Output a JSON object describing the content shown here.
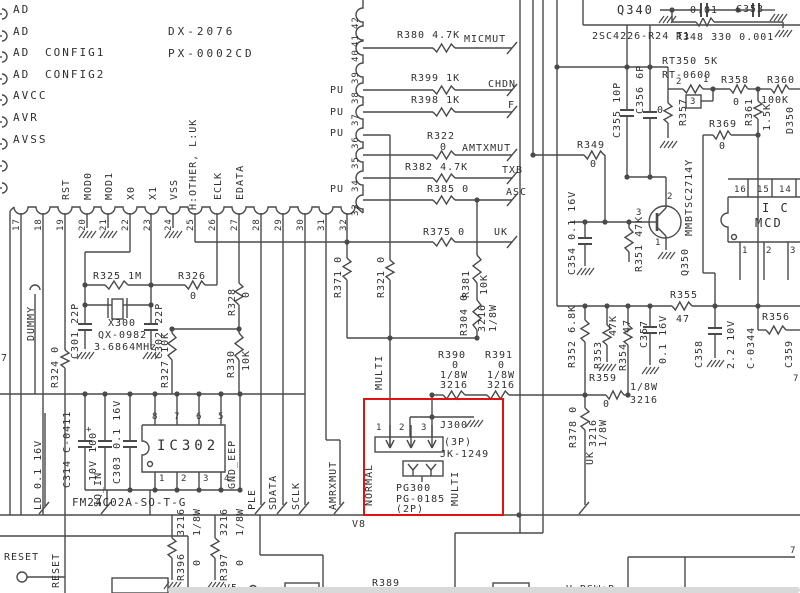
{
  "colors": {
    "background": "#ffffff",
    "wire": "#4a4a4a",
    "text": "#303030",
    "highlight": "#e01212",
    "window_edge": "#d9d9d9"
  },
  "highlight": {
    "x": 363,
    "y": 398,
    "w": 137,
    "h": 114
  },
  "window_edge": {
    "x": 168,
    "y": 587,
    "w": 632,
    "h": 6
  },
  "schematic": {
    "labels": [
      {
        "t": "AD",
        "x": 13,
        "y": 4,
        "s": 11,
        "ls": 2
      },
      {
        "t": "AD",
        "x": 13,
        "y": 26,
        "s": 11,
        "ls": 2
      },
      {
        "t": "AD",
        "x": 13,
        "y": 47,
        "s": 11,
        "ls": 2
      },
      {
        "t": "CONFIG1",
        "x": 45,
        "y": 47,
        "s": 11,
        "ls": 2
      },
      {
        "t": "AD",
        "x": 13,
        "y": 69,
        "s": 11,
        "ls": 2
      },
      {
        "t": "CONFIG2",
        "x": 45,
        "y": 69,
        "s": 11,
        "ls": 2
      },
      {
        "t": "AVCC",
        "x": 13,
        "y": 90,
        "s": 11,
        "ls": 2
      },
      {
        "t": "AVR",
        "x": 13,
        "y": 112,
        "s": 11,
        "ls": 2
      },
      {
        "t": "AVSS",
        "x": 13,
        "y": 134,
        "s": 11,
        "ls": 2
      },
      {
        "t": "DX-2076",
        "x": 168,
        "y": 26,
        "s": 11,
        "ls": 3
      },
      {
        "t": "PX-0002CD",
        "x": 168,
        "y": 48,
        "s": 11,
        "ls": 3
      },
      {
        "t": "H:OTHER, L:UK",
        "x": 188,
        "y": 210,
        "o": "v"
      },
      {
        "t": "RST",
        "x": 61,
        "y": 200,
        "o": "v"
      },
      {
        "t": "MOD0",
        "x": 83,
        "y": 200,
        "o": "v"
      },
      {
        "t": "MOD1",
        "x": 104,
        "y": 200,
        "o": "v"
      },
      {
        "t": "X0",
        "x": 126,
        "y": 200,
        "o": "v"
      },
      {
        "t": "X1",
        "x": 148,
        "y": 200,
        "o": "v"
      },
      {
        "t": "VSS",
        "x": 169,
        "y": 200,
        "o": "v"
      },
      {
        "t": "ECLK",
        "x": 213,
        "y": 200,
        "o": "v"
      },
      {
        "t": "EDATA",
        "x": 235,
        "y": 200,
        "o": "v"
      },
      {
        "t": "17",
        "x": 12,
        "y": 231,
        "o": "v",
        "s": 9
      },
      {
        "t": "18",
        "x": 34,
        "y": 231,
        "o": "v",
        "s": 9
      },
      {
        "t": "19",
        "x": 56,
        "y": 231,
        "o": "v",
        "s": 9
      },
      {
        "t": "20",
        "x": 78,
        "y": 231,
        "o": "v",
        "s": 9
      },
      {
        "t": "21",
        "x": 99,
        "y": 231,
        "o": "v",
        "s": 9
      },
      {
        "t": "22",
        "x": 121,
        "y": 231,
        "o": "v",
        "s": 9
      },
      {
        "t": "23",
        "x": 143,
        "y": 231,
        "o": "v",
        "s": 9
      },
      {
        "t": "24",
        "x": 164,
        "y": 231,
        "o": "v",
        "s": 9
      },
      {
        "t": "25",
        "x": 186,
        "y": 231,
        "o": "v",
        "s": 9
      },
      {
        "t": "26",
        "x": 208,
        "y": 231,
        "o": "v",
        "s": 9
      },
      {
        "t": "27",
        "x": 230,
        "y": 231,
        "o": "v",
        "s": 9
      },
      {
        "t": "28",
        "x": 252,
        "y": 231,
        "o": "v",
        "s": 9
      },
      {
        "t": "29",
        "x": 274,
        "y": 231,
        "o": "v",
        "s": 9
      },
      {
        "t": "30",
        "x": 296,
        "y": 231,
        "o": "v",
        "s": 9
      },
      {
        "t": "31",
        "x": 317,
        "y": 231,
        "o": "v",
        "s": 9
      },
      {
        "t": "32",
        "x": 339,
        "y": 231,
        "o": "v",
        "s": 9
      },
      {
        "t": "33",
        "x": 351,
        "y": 216,
        "o": "v",
        "s": 9
      },
      {
        "t": "34",
        "x": 351,
        "y": 192,
        "o": "v",
        "s": 9
      },
      {
        "t": "35",
        "x": 351,
        "y": 169,
        "o": "v",
        "s": 9
      },
      {
        "t": "36",
        "x": 351,
        "y": 149,
        "o": "v",
        "s": 9
      },
      {
        "t": "37",
        "x": 351,
        "y": 126,
        "o": "v",
        "s": 9
      },
      {
        "t": "38",
        "x": 351,
        "y": 104,
        "o": "v",
        "s": 9
      },
      {
        "t": "39",
        "x": 351,
        "y": 84,
        "o": "v",
        "s": 9
      },
      {
        "t": "40",
        "x": 351,
        "y": 62,
        "o": "v",
        "s": 9
      },
      {
        "t": "41",
        "x": 351,
        "y": 47,
        "o": "v",
        "s": 9
      },
      {
        "t": "42",
        "x": 351,
        "y": 29,
        "o": "v",
        "s": 9
      },
      {
        "t": "PU",
        "x": 330,
        "y": 85
      },
      {
        "t": "PU",
        "x": 330,
        "y": 107
      },
      {
        "t": "PU",
        "x": 330,
        "y": 128
      },
      {
        "t": "PU",
        "x": 330,
        "y": 184
      },
      {
        "t": "R380 4.7K",
        "x": 397,
        "y": 30
      },
      {
        "t": "MICMUT",
        "x": 464,
        "y": 34
      },
      {
        "t": "R399 1K",
        "x": 411,
        "y": 73
      },
      {
        "t": "CHDN",
        "x": 488,
        "y": 79
      },
      {
        "t": "R398 1K",
        "x": 411,
        "y": 95
      },
      {
        "t": "F",
        "x": 508,
        "y": 100
      },
      {
        "t": "R322",
        "x": 427,
        "y": 131
      },
      {
        "t": "0",
        "x": 440,
        "y": 142
      },
      {
        "t": "AMTXMUT",
        "x": 462,
        "y": 143
      },
      {
        "t": "R382 4.7K",
        "x": 405,
        "y": 162
      },
      {
        "t": "TXB",
        "x": 502,
        "y": 165
      },
      {
        "t": "R385 0",
        "x": 427,
        "y": 184
      },
      {
        "t": "ASC",
        "x": 506,
        "y": 187
      },
      {
        "t": "R375 0",
        "x": 423,
        "y": 227
      },
      {
        "t": "UK",
        "x": 494,
        "y": 227
      },
      {
        "t": "DUMMY",
        "x": 26,
        "y": 341,
        "o": "v"
      },
      {
        "t": "7",
        "x": 1,
        "y": 353
      },
      {
        "t": "R324 0",
        "x": 50,
        "y": 388,
        "o": "v"
      },
      {
        "t": "R325 1M",
        "x": 93,
        "y": 271
      },
      {
        "t": "R326",
        "x": 178,
        "y": 271
      },
      {
        "t": "0",
        "x": 190,
        "y": 291
      },
      {
        "t": "C301 22P",
        "x": 70,
        "y": 359,
        "o": "v"
      },
      {
        "t": "C302 22P",
        "x": 154,
        "y": 359,
        "o": "v"
      },
      {
        "t": "X300",
        "x": 108,
        "y": 318
      },
      {
        "t": "QX-0982",
        "x": 98,
        "y": 330
      },
      {
        "t": "3.6864MHz",
        "x": 94,
        "y": 342
      },
      {
        "t": "R327 10K",
        "x": 160,
        "y": 388,
        "o": "v"
      },
      {
        "t": "R328",
        "x": 227,
        "y": 316,
        "o": "v"
      },
      {
        "t": "0",
        "x": 241,
        "y": 298,
        "o": "v"
      },
      {
        "t": "R330",
        "x": 226,
        "y": 378,
        "o": "v"
      },
      {
        "t": "10K",
        "x": 241,
        "y": 371,
        "o": "v"
      },
      {
        "t": "R371 0",
        "x": 333,
        "y": 298,
        "o": "v"
      },
      {
        "t": "R321 0",
        "x": 376,
        "y": 298,
        "o": "v"
      },
      {
        "t": "R381",
        "x": 461,
        "y": 298,
        "o": "v"
      },
      {
        "t": "10K",
        "x": 479,
        "y": 295,
        "o": "v"
      },
      {
        "t": "R304 0",
        "x": 459,
        "y": 336,
        "o": "v"
      },
      {
        "t": "3216",
        "x": 477,
        "y": 332,
        "o": "v"
      },
      {
        "t": "1/8W",
        "x": 488,
        "y": 332,
        "o": "v"
      },
      {
        "t": "MULTI",
        "x": 374,
        "y": 390,
        "o": "v"
      },
      {
        "t": "C314 C-0411",
        "x": 62,
        "y": 488,
        "o": "v"
      },
      {
        "t": "+",
        "x": 86,
        "y": 425,
        "s": 9
      },
      {
        "t": "10V 100",
        "x": 88,
        "y": 481,
        "o": "v"
      },
      {
        "t": "C303 0.1 16V",
        "x": 112,
        "y": 484,
        "o": "v"
      },
      {
        "t": "8",
        "x": 152,
        "y": 412,
        "s": 9
      },
      {
        "t": "7",
        "x": 174,
        "y": 412,
        "s": 9
      },
      {
        "t": "6",
        "x": 196,
        "y": 412,
        "s": 9
      },
      {
        "t": "5",
        "x": 218,
        "y": 412,
        "s": 9
      },
      {
        "t": "1",
        "x": 159,
        "y": 474,
        "s": 9
      },
      {
        "t": "2",
        "x": 181,
        "y": 474,
        "s": 9
      },
      {
        "t": "3",
        "x": 203,
        "y": 474,
        "s": 9
      },
      {
        "t": "4",
        "x": 224,
        "y": 474,
        "s": 9
      },
      {
        "t": "IC302",
        "x": 157,
        "y": 441,
        "s": 14,
        "ls": 4
      },
      {
        "t": "FM24C02A-SO-T-G",
        "x": 72,
        "y": 497,
        "s": 11
      },
      {
        "t": "GND_EEP",
        "x": 227,
        "y": 489,
        "o": "v"
      },
      {
        "t": "PLE",
        "x": 247,
        "y": 510,
        "o": "v"
      },
      {
        "t": "SDATA",
        "x": 268,
        "y": 510,
        "o": "v"
      },
      {
        "t": "SCLK",
        "x": 291,
        "y": 510,
        "o": "v"
      },
      {
        "t": "AMRXMUT",
        "x": 328,
        "y": 510,
        "o": "v"
      },
      {
        "t": "LD 0.1 16V",
        "x": 33,
        "y": 510,
        "o": "v"
      },
      {
        "t": "SQ_IN",
        "x": 93,
        "y": 507,
        "o": "v"
      },
      {
        "t": "R390",
        "x": 438,
        "y": 350
      },
      {
        "t": "0",
        "x": 452,
        "y": 360
      },
      {
        "t": "1/8W",
        "x": 440,
        "y": 370
      },
      {
        "t": "3216",
        "x": 440,
        "y": 380
      },
      {
        "t": "R391",
        "x": 485,
        "y": 350
      },
      {
        "t": "0",
        "x": 498,
        "y": 360
      },
      {
        "t": "1/8W",
        "x": 487,
        "y": 370
      },
      {
        "t": "3216",
        "x": 487,
        "y": 380
      },
      {
        "t": "1",
        "x": 376,
        "y": 423,
        "s": 9
      },
      {
        "t": "2",
        "x": 399,
        "y": 423,
        "s": 9
      },
      {
        "t": "3",
        "x": 421,
        "y": 423,
        "s": 9
      },
      {
        "t": "J300",
        "x": 440,
        "y": 420
      },
      {
        "t": "(3P)",
        "x": 444,
        "y": 437
      },
      {
        "t": "JK-1249",
        "x": 440,
        "y": 449
      },
      {
        "t": "PG300",
        "x": 396,
        "y": 483
      },
      {
        "t": "PG-0185",
        "x": 396,
        "y": 494
      },
      {
        "t": "(2P)",
        "x": 396,
        "y": 504
      },
      {
        "t": "NORMAL",
        "x": 364,
        "y": 506,
        "o": "v"
      },
      {
        "t": "MULTI",
        "x": 450,
        "y": 506,
        "o": "v"
      },
      {
        "t": "V8",
        "x": 352,
        "y": 519
      },
      {
        "t": "Q340",
        "x": 617,
        "y": 5,
        "s": 12,
        "ls": 2
      },
      {
        "t": "0.01",
        "x": 690,
        "y": 5
      },
      {
        "t": "C353",
        "x": 736,
        "y": 4
      },
      {
        "t": "2SC4226-R24 T1",
        "x": 592,
        "y": 31
      },
      {
        "t": "R348 330 0.001",
        "x": 676,
        "y": 32
      },
      {
        "t": "RT350 5K",
        "x": 662,
        "y": 56
      },
      {
        "t": "RT-0600",
        "x": 662,
        "y": 70
      },
      {
        "t": "2",
        "x": 676,
        "y": 77,
        "s": 9
      },
      {
        "t": "1",
        "x": 703,
        "y": 75,
        "s": 9
      },
      {
        "t": "3",
        "x": 690,
        "y": 97,
        "s": 9
      },
      {
        "t": "R358",
        "x": 721,
        "y": 75
      },
      {
        "t": "0",
        "x": 733,
        "y": 97
      },
      {
        "t": "R360",
        "x": 767,
        "y": 75
      },
      {
        "t": "100K",
        "x": 761,
        "y": 95
      },
      {
        "t": "R361",
        "x": 744,
        "y": 126,
        "o": "v"
      },
      {
        "t": "1.5K",
        "x": 762,
        "y": 131,
        "o": "v"
      },
      {
        "t": "D350",
        "x": 785,
        "y": 134,
        "o": "v"
      },
      {
        "t": "R369",
        "x": 709,
        "y": 119
      },
      {
        "t": "0",
        "x": 719,
        "y": 141
      },
      {
        "t": "R357",
        "x": 678,
        "y": 126,
        "o": "v"
      },
      {
        "t": "0",
        "x": 657,
        "y": 105
      },
      {
        "t": "C355 10P",
        "x": 612,
        "y": 138,
        "o": "v"
      },
      {
        "t": "C356 6P",
        "x": 635,
        "y": 114,
        "o": "v"
      },
      {
        "t": "R349",
        "x": 577,
        "y": 140
      },
      {
        "t": "0",
        "x": 590,
        "y": 159
      },
      {
        "t": "C354 0.1 16V",
        "x": 567,
        "y": 275,
        "o": "v"
      },
      {
        "t": "R351 47K",
        "x": 634,
        "y": 272,
        "o": "v"
      },
      {
        "t": "MMBTSC2714Y",
        "x": 684,
        "y": 236,
        "o": "v"
      },
      {
        "t": "Q350",
        "x": 680,
        "y": 276,
        "o": "v"
      },
      {
        "t": "2",
        "x": 667,
        "y": 192,
        "s": 9
      },
      {
        "t": "3",
        "x": 636,
        "y": 208,
        "s": 9
      },
      {
        "t": "1",
        "x": 655,
        "y": 238,
        "s": 9
      },
      {
        "t": "16",
        "x": 734,
        "y": 185,
        "s": 9
      },
      {
        "t": "15",
        "x": 757,
        "y": 185,
        "s": 9
      },
      {
        "t": "14",
        "x": 779,
        "y": 185,
        "s": 9
      },
      {
        "t": "I C",
        "x": 762,
        "y": 203,
        "s": 12,
        "ls": 2
      },
      {
        "t": "MCD",
        "x": 755,
        "y": 218,
        "s": 12,
        "ls": 2
      },
      {
        "t": "1",
        "x": 742,
        "y": 246,
        "s": 9
      },
      {
        "t": "2",
        "x": 766,
        "y": 246,
        "s": 9
      },
      {
        "t": "3",
        "x": 790,
        "y": 246,
        "s": 9
      },
      {
        "t": "R355",
        "x": 670,
        "y": 290
      },
      {
        "t": "47",
        "x": 676,
        "y": 314
      },
      {
        "t": "R352 6.8K",
        "x": 567,
        "y": 368,
        "o": "v"
      },
      {
        "t": "R353",
        "x": 593,
        "y": 369,
        "o": "v"
      },
      {
        "t": "47K",
        "x": 608,
        "y": 336,
        "o": "v"
      },
      {
        "t": "R354",
        "x": 618,
        "y": 371,
        "o": "v"
      },
      {
        "t": "47",
        "x": 622,
        "y": 333,
        "o": "v"
      },
      {
        "t": "C357",
        "x": 639,
        "y": 348,
        "o": "v"
      },
      {
        "t": "0.1 16V",
        "x": 658,
        "y": 364,
        "o": "v"
      },
      {
        "t": "C358",
        "x": 694,
        "y": 368,
        "o": "v"
      },
      {
        "t": "2.2 10V",
        "x": 726,
        "y": 369,
        "o": "v"
      },
      {
        "t": "C-0344",
        "x": 746,
        "y": 369,
        "o": "v"
      },
      {
        "t": "R356",
        "x": 762,
        "y": 312
      },
      {
        "t": "C359",
        "x": 784,
        "y": 368,
        "o": "v"
      },
      {
        "t": "7",
        "x": 793,
        "y": 374,
        "s": 9
      },
      {
        "t": "R359",
        "x": 589,
        "y": 373
      },
      {
        "t": "0",
        "x": 603,
        "y": 399
      },
      {
        "t": "1/8W",
        "x": 630,
        "y": 382
      },
      {
        "t": "3216",
        "x": 630,
        "y": 395
      },
      {
        "t": "R378 0",
        "x": 568,
        "y": 448,
        "o": "v"
      },
      {
        "t": "3216",
        "x": 588,
        "y": 447,
        "o": "v"
      },
      {
        "t": "1/8W",
        "x": 598,
        "y": 447,
        "o": "v"
      },
      {
        "t": "UK",
        "x": 585,
        "y": 465,
        "o": "v"
      },
      {
        "t": "RESET",
        "x": 4,
        "y": 552
      },
      {
        "t": "RESET",
        "x": 51,
        "y": 588,
        "o": "v"
      },
      {
        "t": "3216",
        "x": 176,
        "y": 536,
        "o": "v"
      },
      {
        "t": "1/8W",
        "x": 192,
        "y": 536,
        "o": "v"
      },
      {
        "t": "R396",
        "x": 176,
        "y": 581,
        "o": "v"
      },
      {
        "t": "0",
        "x": 192,
        "y": 566,
        "o": "v"
      },
      {
        "t": "3216",
        "x": 219,
        "y": 536,
        "o": "v"
      },
      {
        "t": "1/8W",
        "x": 235,
        "y": 536,
        "o": "v"
      },
      {
        "t": "R397",
        "x": 219,
        "y": 581,
        "o": "v"
      },
      {
        "t": "0",
        "x": 235,
        "y": 566,
        "o": "v"
      },
      {
        "t": "V5",
        "x": 224,
        "y": 583
      },
      {
        "t": "R389",
        "x": 372,
        "y": 578
      },
      {
        "t": "0",
        "x": 384,
        "y": 588
      },
      {
        "t": "V_RSW+B",
        "x": 566,
        "y": 584
      },
      {
        "t": "7",
        "x": 790,
        "y": 546,
        "s": 9
      }
    ]
  }
}
